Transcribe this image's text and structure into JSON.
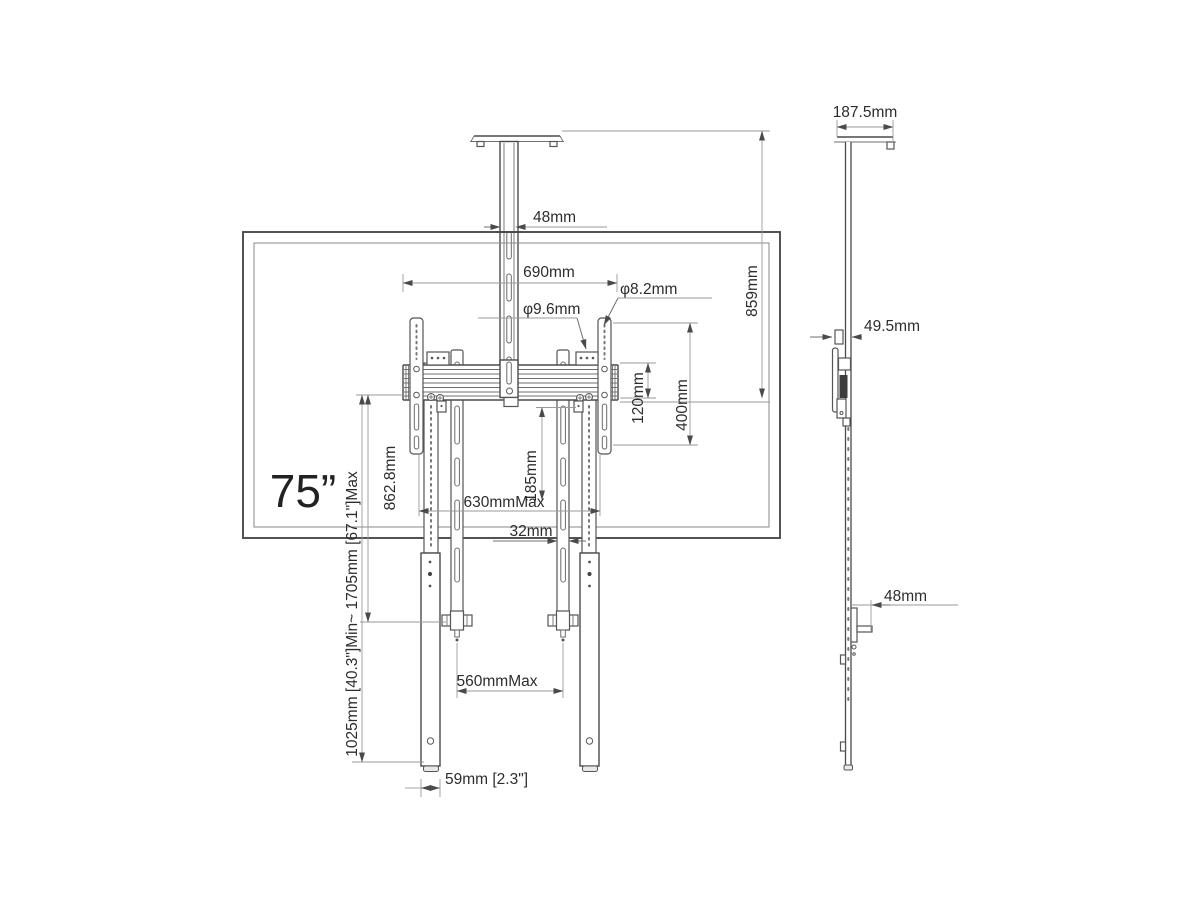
{
  "front": {
    "size_label": "75”",
    "dims": {
      "pole_width": "48mm",
      "rail_width": "690mm",
      "hole_large": "φ9.6mm",
      "hole_small": "φ8.2mm",
      "drop_height": "859mm",
      "rail_height": "120mm",
      "vesa_height": "400mm",
      "upright_length": "862.8mm",
      "strap_drop": "185mm",
      "strap_spread": "630mmMax",
      "strap_width": "32mm",
      "height_range": "1025mm [40.3\"]Min~ 1705mm [67.1\"]Max",
      "leg_spread": "560mmMax",
      "leg_width": "59mm [2.3\"]"
    }
  },
  "side": {
    "dims": {
      "plate_depth": "187.5mm",
      "mount_depth": "49.5mm",
      "hook_offset": "48mm"
    }
  },
  "palette": {
    "ink": "#4a4a4a",
    "dim_line": "#9a9a9a",
    "label": "#2d2d2d",
    "background": "#ffffff"
  }
}
